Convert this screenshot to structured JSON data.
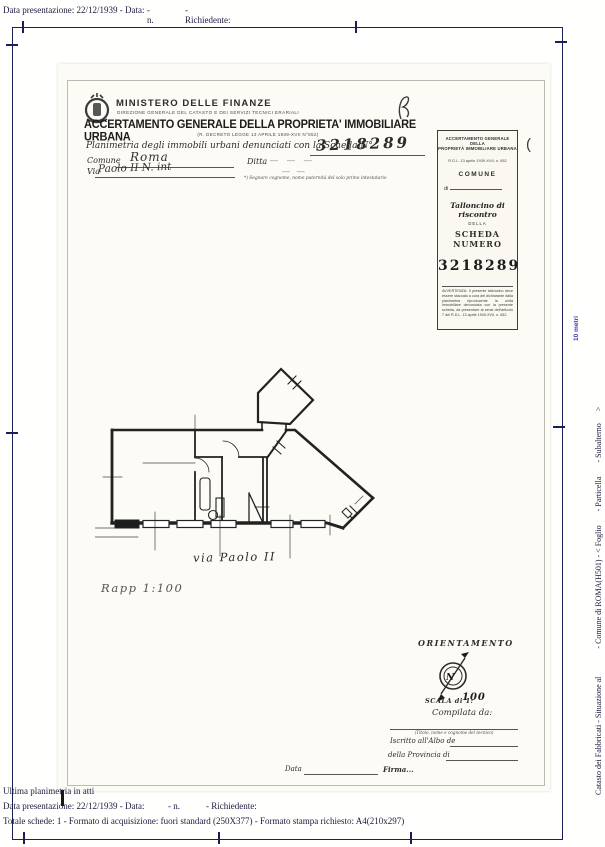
{
  "viewer": {
    "top_line": {
      "p1": "Data presentazione: 22/12/1939 - Data:",
      "p2": "- n.",
      "p3": "- Richiedente:"
    },
    "bottom": {
      "ultima": "Ultima planimetria in atti",
      "line1": {
        "p1": "Data presentazione: 22/12/1939 - Data:",
        "p2": "- n.",
        "p3": "- Richiedente:"
      },
      "line2": "Totale schede: 1 - Formato di acquisizione: fuori standard (250X377) - Formato stampa richiesto: A4(210x297)"
    },
    "side": {
      "line1": "Catasto dei Fabbricati - Situazione al              - Comune di ROMA(H501) - < Foglio       - Particella       - Subalterno      >",
      "line2": "VIA PAOLO SECONDO n.        Interno        Piano",
      "scale_note": "10 metri",
      "scale_note_color": "#3a3aae"
    },
    "frame_color": "#1d1d57",
    "text_color": "#1b1b3f"
  },
  "document": {
    "header": {
      "ministry": "MINISTERO DELLE FINANZE",
      "direction": "DIREZIONE GENERALE DEL CATASTO E DEI SERVIZI TECNICI ERARIALI",
      "title": "ACCERTAMENTO GENERALE DELLA PROPRIETA' IMMOBILIARE URBANA",
      "subtitle": "(R. DECRETO LEGGE 13 APRILE 1939-XVII N°652)",
      "planimetria_label": "Planimetria degli immobili urbani denunciati con la Scheda N°",
      "scheda_number": "3218289",
      "comune_label": "Comune",
      "comune_value": "Roma",
      "ditta_label": "Ditta",
      "ditta_dashes": "—    —    —",
      "ditta_dashes2": "—   —",
      "via_label": "Via",
      "via_value": "Paolo II  N.   int",
      "footnote": "*) Segnare cognome, nome paternità del solo primo intestatario"
    },
    "talloncino": {
      "header1": "ACCERTAMENTO GENERALE DELLA",
      "header2": "PROPRIETÀ IMMOBILIARE URBANA",
      "law": "R.D.L. 13 aprile 1939-XVII, n. 652",
      "comune": "COMUNE",
      "di": "di",
      "title": "Talloncino di riscontro",
      "della": "DELLA",
      "scheda_numero": "SCHEDA NUMERO",
      "number": "3218289",
      "avvertenza": "AVVERTENZA: Il presente talloncino deve essere staccato a cura del dichiarante dalla planimetria riproducente la unità immobiliare denunciata con la presente scheda, da presentare ai sensi dell'articolo 7 del R.D.L. 13 aprile 1939-XVII, n. 652.",
      "paren_mark": "("
    },
    "plan": {
      "street_label": "via Paolo II",
      "scale_note": "Rapp 1:100"
    },
    "orientation": {
      "title": "ORIENTAMENTO",
      "north": "N",
      "scala_label": "SCALA di 1:",
      "scala_value": "100",
      "compilata": "Compilata da:",
      "tecnico_note": "(Titolo, nome e cognome del tecnico)",
      "albo": "Iscritto all'Albo de",
      "provincia": "della Provincia di",
      "data_label": "Data",
      "firma_label": "Firma..."
    }
  }
}
